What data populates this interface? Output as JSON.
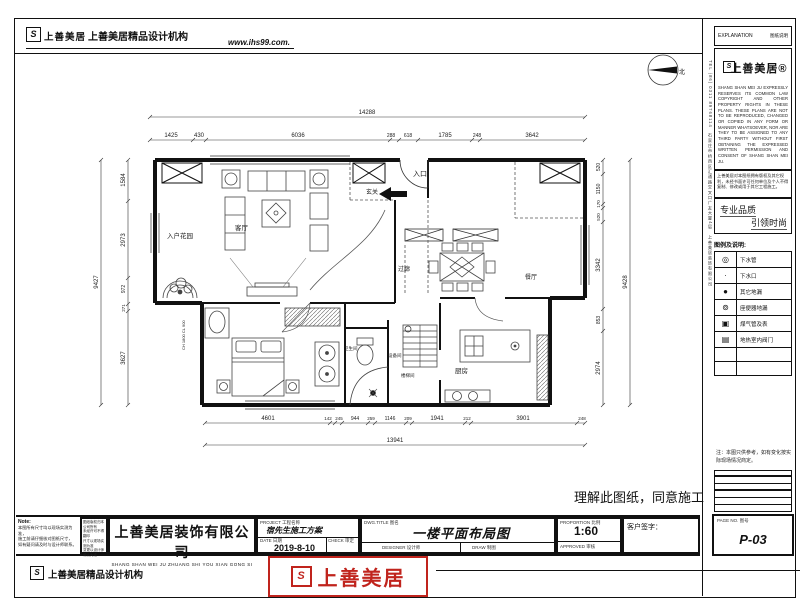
{
  "header": {
    "brand": "上善美居",
    "agency": "上善美居精品设计机构",
    "website": "www.ihs99.com."
  },
  "sidebar": {
    "explanation_label": "EXPLANATION",
    "explanation_label_cn": "图纸说明",
    "brand": "上善美居®",
    "copyright_en": "SHANG SHAN MEI JU EXPRESSLY RESERVES ITS COMMON LAW COPYRIGHT AND OTHER PROPERTY RIGHTS IN THESE PLANS. THESE PLANS ARE NOT TO BE REPRODUCED, CHANGED OR COPIED IN ANY FORM OR MANNER WHATSOEVER, NOR ARE THEY TO BE ASSIGNED TO ANY THIRD PARTY WITHOUT FIRST OBTAINING THE EXPRESSED WRITTEN PERMISSION AND CONSENT OF SHANG SHAN MEI JU.",
    "notice_cn": "上善美居对本图纸拥有版权及其它权利，未经书面许可任何单位及个人不得复制、修改或用于其它工程施工。",
    "slogan1": "专业品质",
    "slogan2": "引领时尚",
    "vertical_info": "TEL (86) 0311 89768114　石家庄市桥西区汇通路交叉口广友大厦4层　上善美居装饰有限公司",
    "legend_title": "图例及说明:",
    "legend": [
      {
        "icon": "drain-pipe-icon",
        "label": "下水管"
      },
      {
        "icon": "drain-outlet-icon",
        "label": "下水口"
      },
      {
        "icon": "floor-drain-icon",
        "label": "其它地漏"
      },
      {
        "icon": "toilet-drain-icon",
        "label": "座便器地漏"
      },
      {
        "icon": "gas-meter-icon",
        "label": "煤气管及表"
      },
      {
        "icon": "heating-valve-icon",
        "label": "地热室内阀门"
      }
    ],
    "note": "注：本图只供参考，如有变化按实际现场情况商定。",
    "pageno_label": "PAGE NO. 图号",
    "pageno": "P-03"
  },
  "statement": "理解此图纸，同意施工",
  "plan": {
    "north_label": "北",
    "entry_label": "入口",
    "rooms": {
      "entry_garden": "入户花园",
      "living": "客厅",
      "foyer": "玄关",
      "corridor": "过廊",
      "dining": "餐厅",
      "bath": "卫生间",
      "equipment": "设备间",
      "stair": "楼梯间",
      "kitchen": "厨房"
    },
    "window_note": "CH 1800 CL 900",
    "dims": {
      "top": {
        "total": "14288",
        "segments": [
          "1425",
          "430",
          "6036",
          "288",
          "618",
          "1785",
          "248",
          "3642"
        ]
      },
      "bottom": {
        "total": "13941",
        "segments": [
          "4601",
          "142",
          "245",
          "944",
          "259",
          "1146",
          "209",
          "1941",
          "212",
          "3901",
          "248"
        ]
      },
      "left": {
        "total": "9427",
        "segments": [
          "1584",
          "2973",
          "972",
          "271",
          "3627"
        ]
      },
      "right": {
        "total": "9428",
        "segments": [
          "520",
          "1150",
          "170",
          "520",
          "3342",
          "853",
          "2974"
        ]
      }
    }
  },
  "titleblock": {
    "note_title": "Note:",
    "note_lines": [
      "本图所有尺寸均以现场实测为准，",
      "施工前请仔细核对图纸尺寸，",
      "如有疑问请及时与设计师联系。"
    ],
    "mini_lines": [
      "图纸版权归本公司所有",
      "未经许可不得翻印",
      "尺寸以现场实测为准",
      "变更以设计师确认为准"
    ],
    "company": "上善美居装饰有限公司",
    "company_pinyin": "SHANG SHAN WEI JU ZHUANG SHI YOU XIAN GONG SI",
    "project_label": "PROJECT 工程名称",
    "project": "宿先生施工方案",
    "date_label": "DATE 日期",
    "date": "2019-8-10",
    "check_label": "CHECK 审定",
    "title_label": "DWG.TITLE 图名",
    "dwg_title": "一楼平面布局图",
    "designer_label": "DESIGNER 设计师",
    "draw_label": "DRAW 制图",
    "proportion_label": "PROPORTION 比例",
    "proportion": "1:60",
    "approved_label": "APPROVED 审核",
    "signature_label": "客户签字："
  },
  "footer": {
    "agency": "上善美居精品设计机构",
    "stamp_brand": "上善美居",
    "stamp_color": "#c0241d"
  }
}
